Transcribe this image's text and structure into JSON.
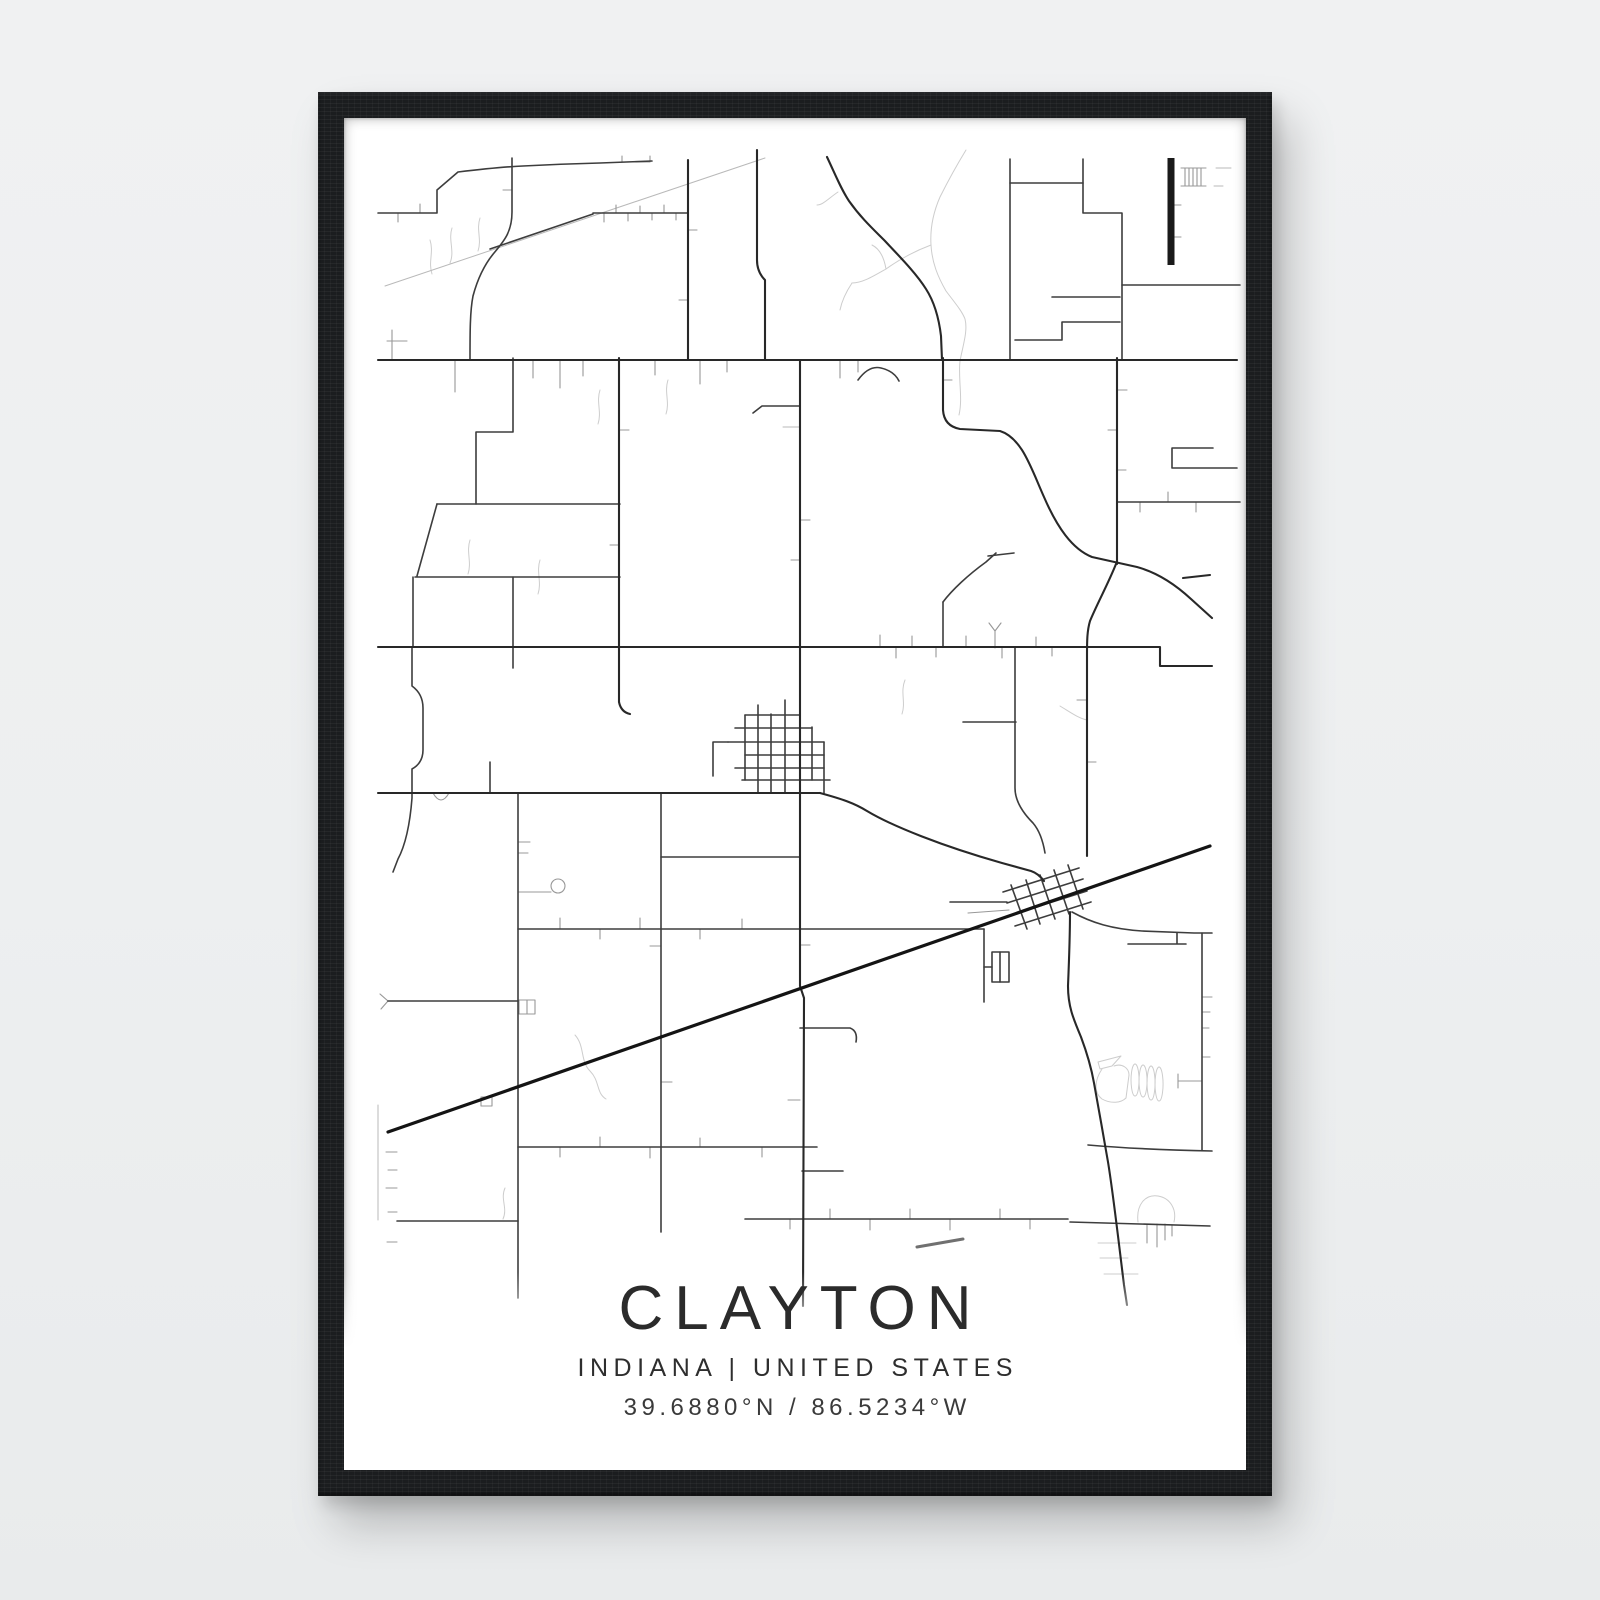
{
  "poster": {
    "title": "CLAYTON",
    "subtitle": "INDIANA | UNITED STATES",
    "coordinates": "39.6880°N / 86.5234°W"
  },
  "colors": {
    "page_bg": "#edeff0",
    "frame": "#1b1d1f",
    "poster_bg": "#ffffff",
    "text": "#2b2b2b",
    "trunk_road": "#282828",
    "major_road": "#3d3d3d",
    "minor_road": "#989898",
    "creek": "#cdcdcd",
    "railroad": "#141414"
  },
  "map": {
    "layers": [
      {
        "name": "creeks",
        "color": "#cdcdcd",
        "width": 1,
        "paths": [
          "M966,150 C955,168 948,181 940,197 C933,213 930,229 931,245 C932,263 938,277 946,291 C955,303 962,311 965,319 C968,331 963,345 960,361",
          "M931,245 C915,251 900,259 886,269 C872,277 862,283 852,283",
          "M886,269 C884,257 880,249 872,245",
          "M960,361 C958,379 963,398 959,415",
          "M452,228 C448,240 455,251 450,263",
          "M480,218 C476,230 482,239 478,251",
          "M430,240 C434,252 428,262 432,274",
          "M575,1035 C585,1046 580,1061 590,1071 C600,1081 596,1093 606,1099",
          "M505,1188 C500,1199 508,1208 503,1219",
          "M838,192 C829,198 823,205 817,205",
          "M852,283 C846,292 842,300 840,310",
          "M1098,1062 L1121,1056 L1112,1066 L1100,1069 Z",
          "M1102,1069 C1094,1081 1094,1093 1102,1099 C1111,1104 1121,1103 1126,1098 L1129,1075 C1129,1068 1122,1063 1114,1066",
          "M1135,1064 a4,16 0 1 0 0.1,0",
          "M1143,1065 a4,16 0 1 0 0.1,0",
          "M1151,1066 a4,17 0 1 0 0.1,0",
          "M1159,1067 a4,17 0 1 0 0.1,0",
          "M1138,1222 C1136,1205 1145,1194 1158,1196 C1170,1198 1177,1209 1174,1222",
          "M1098,1243 H1136",
          "M1100,1258 H1128",
          "M1104,1274 H1138",
          "M1060,706 C1070,712 1078,718 1087,720",
          "M600,390 C596,402 602,412 598,424",
          "M668,380 C664,392 670,402 666,414",
          "M540,560 C536,572 542,582 538,594",
          "M470,540 C466,552 472,562 468,574",
          "M905,680 C900,692 906,702 902,714"
        ]
      },
      {
        "name": "faint-roads",
        "color": "#b9b9b9",
        "width": 1,
        "paths": [
          "M385,286 L765,158",
          "M783,427 H800",
          "M1216,168 H1231",
          "M1214,186 H1223",
          "M378,1105 V1220"
        ]
      },
      {
        "name": "minor-roads",
        "color": "#989898",
        "width": 1.1,
        "paths": [
          "M604,213 V222 M616,213 V205 M628,213 V221 M640,213 V206 M652,213 V220 M664,213 V205 M676,213 V220",
          "M398,213 V222 M420,213 V204",
          "M455,360 V392 M533,360 V378 M560,360 V388 M583,360 V376 M655,360 V375 M700,360 V384 M727,360 V372 M840,360 V378 M858,360 V372",
          "M880,647 V635 M896,647 V658 M912,647 V636 M936,647 V657 M966,647 V636 M1002,647 V658 M1036,647 V637 M1052,647 V656",
          "M518,842 H530 M518,853 H528",
          "M661,946 H650 M661,1082 H672",
          "M397,1152 H386 M397,1170 H388 M397,1188 H386 M397,1212 H388 M397,1242 H387",
          "M800,1100 H788 M800,945 H810 M800,520 H810 M800,560 H791",
          "M688,230 H697 M688,300 H679",
          "M512,190 H503",
          "M943,380 H952",
          "M619,430 H629 M619,545 H610",
          "M1117,390 H1127 M1117,430 H1108 M1117,470 H1126",
          "M1140,502 V512 M1168,502 V492 M1196,502 V512",
          "M433,793 Q441,807 449,793",
          "M560,929 V918 M600,929 V939 M640,929 V918 M700,929 V939 M742,929 V919",
          "M560,1147 V1157 M600,1147 V1137 M650,1147 V1158 M700,1147 V1138 M762,1147 V1157",
          "M790,1219 V1229 M830,1219 V1209 M870,1219 V1230 M910,1219 V1209 M950,1219 V1230 M1000,1219 V1209 M1030,1219 V1229",
          "M1147,1224 V1243 M1157,1224 V1247 M1165,1224 V1240 M1172,1225 V1236",
          "M481,1097 h11 v9 h-11 Z",
          "M518,892 H551",
          "M551,886 a7,7 0 1 0 14,0 a7,7 0 1 0 -14,0",
          "M1202,997 H1212 M1202,1012 H1210 M1202,1028 H1209 M1202,1057 H1210 M1178,1081 H1202 M1178,1074 V1088",
          "M1171,205 H1181 M1171,237 H1181",
          "M1181,168 H1206 M1181,186 H1206 M1185,168 V186 M1189,168 V186 M1193,168 V186 M1197,168 V186 M1201,168 V186",
          "M392,330 V360 M387,341 H407",
          "M622,156 V162 H650 V156",
          "M995,648 V631 M989,623 L995,631 L1001,623",
          "M1087,700 H1077 M1087,762 H1096",
          "M519,1000 h16 v14 h-16 Z M527,1000 V1014",
          "M388,1001 L380,994 M388,1001 L381,1009",
          "M968,913 L1009,910"
        ]
      },
      {
        "name": "major-roads",
        "color": "#3d3d3d",
        "width": 1.6,
        "paths": [
          "M378,213 H437 V190 L458,172 Q500,167 523,166 Q560,164 600,163 L652,161",
          "M512,158 V212 C512,232 504,241 494,253 C484,265 477,281 473,296 C470,311 470,332 470,360",
          "M593,213 H688",
          "M490,249 L593,214",
          "M513,358 V432 H476 V504",
          "M437,504 H620",
          "M437,504 L417,576",
          "M415,577 H620",
          "M513,577 V668",
          "M413,577 V647",
          "M412,647 V686 Q423,694 423,708 V750 Q423,763 412,769 V798 C410,824 406,844 398,859 L393,872",
          "M490,762 V793",
          "M518,793 V1298",
          "M661,793 V1232",
          "M661,857 H800",
          "M518,929 H984",
          "M984,929 V1002",
          "M992,952 h17 v30 h-17 Z",
          "M1000,952 V982",
          "M984,967 H992",
          "M963,722 H1016",
          "M1015,648 V788 C1015,801 1023,813 1033,823 C1039,830 1043,841 1045,853",
          "M943,602 V647",
          "M943,602 C952,590 968,575 986,562 L996,553",
          "M988,556 L1014,553",
          "M858,380 Q869,365 881,368 Q894,371 899,381",
          "M753,413 L762,406 H800",
          "M1010,159 V360",
          "M1083,159 V213 H1122 V360",
          "M1010,183 H1083",
          "M1122,285 H1240",
          "M1117,502 H1240",
          "M1213,448 H1172 V468 H1237",
          "M1052,297 H1120",
          "M1015,340 H1062 V322 H1120",
          "M745,715 V780 M758,705 V793 M771,714 V793 M785,700 V793 M812,727 V780 M824,742 V793",
          "M745,715 H800 M735,728 H812 M728,742 H824 M745,755 H824 M735,768 H824 M742,780 H830",
          "M713,742 H728 M713,742 V776",
          "M1003,892 L1079,868 M1007,903 L1083,879 M1011,915 L1087,891 M1015,926 L1091,902",
          "M1011,885 L1027,929 M1026,880 L1040,924 M1040,875 L1055,919 M1054,870 L1069,914 M1068,865 L1083,909",
          "M950,902 H1007",
          "M800,1028 H850 Q858,1031 856,1042",
          "M745,1219 H1068",
          "M1070,1222 L1210,1226",
          "M518,1147 H817",
          "M397,1221 H518",
          "M388,1001 H518",
          "M1088,1145 C1122,1148 1162,1150 1212,1151",
          "M1202,933 V1150",
          "M1072,912 C1092,923 1112,929 1142,931 L1194,933 H1212",
          "M1128,944 H1186 M1177,933 V944",
          "M802,1171 H843"
        ]
      },
      {
        "name": "trunk-roads",
        "color": "#282828",
        "width": 2.1,
        "paths": [
          "M378,360 H1237",
          "M378,647 H1160 V666 H1212",
          "M378,793 H820",
          "M800,360 V986 L804,998 L803,1306",
          "M688,160 V360",
          "M757,150 V260 Q757,272 765,280 V360",
          "M619,358 V702 Q621,712 630,714",
          "M943,358 V410 Q944,426 960,429 L1000,431 C1022,438 1031,468 1044,497 C1057,527 1072,549 1092,557 L1137,567 C1159,573 1177,586 1191,599 L1212,618",
          "M1117,358 V564",
          "M1116,564 C1108,584 1097,604 1090,621 C1087,631 1087,642 1087,656 V856",
          "M827,157 C836,176 841,189 849,201 C861,218 873,229 885,241 C899,256 916,273 926,289 C935,303 939,319 941,336 L942,360",
          "M1183,578 L1210,575",
          "M1070,912 C1070,935 1069,962 1068,986 C1068,1006 1073,1018 1081,1037 C1087,1053 1091,1066 1094,1083 C1098,1106 1104,1138 1108,1162 C1113,1192 1119,1245 1124,1285 L1127,1305",
          "M820,793 C842,799 854,803 867,811 C892,826 942,846 1002,863 L1031,871 C1037,873 1041,877 1044,881"
        ]
      },
      {
        "name": "railroad",
        "color": "#141414",
        "width": 3.2,
        "paths": [
          "M388,1132 L1210,846"
        ]
      },
      {
        "name": "runway",
        "color": "#1a1a1a",
        "width": 7,
        "paths": [
          "M1171,158 V265"
        ]
      },
      {
        "name": "gray-dash",
        "color": "#707070",
        "width": 3,
        "paths": [
          "M917,1247 L963,1239"
        ]
      }
    ]
  }
}
